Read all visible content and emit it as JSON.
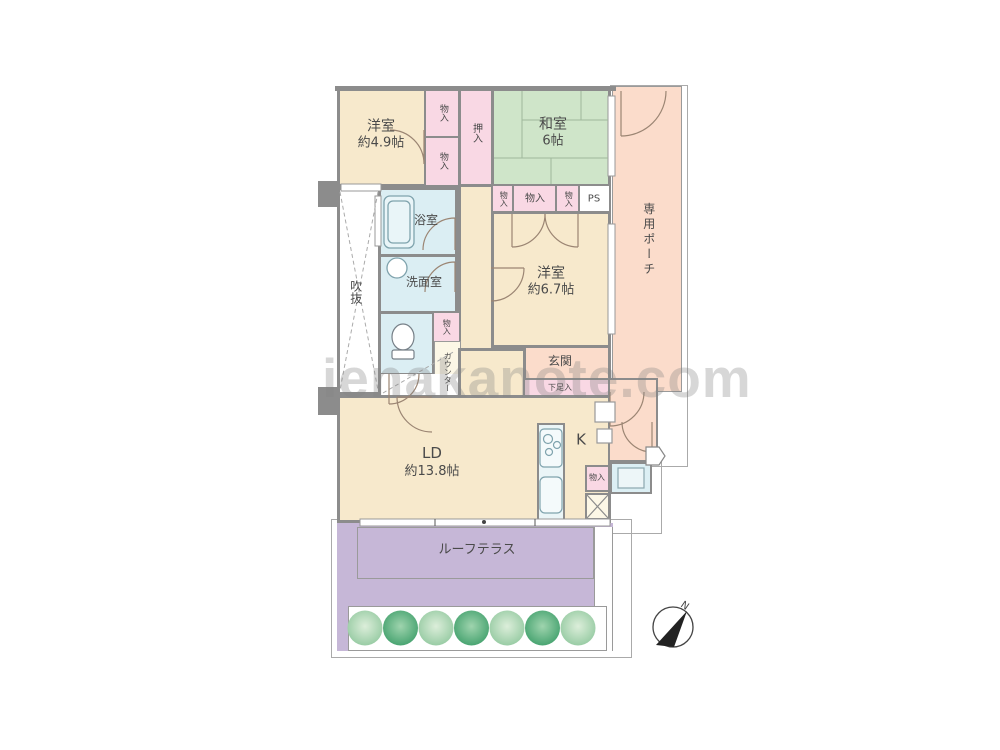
{
  "watermark": "ienakanote.com",
  "compass": {
    "north_label": "N"
  },
  "rooms": {
    "yoshitsu49": {
      "name": "洋室",
      "size": "約4.9帖"
    },
    "washitsu": {
      "name": "和室",
      "size": "6帖"
    },
    "yoshitsu67": {
      "name": "洋室",
      "size": "約6.7帖"
    },
    "ld": {
      "name": "LD",
      "size": "約13.8帖"
    },
    "kitchen": {
      "label": "K"
    },
    "bath": {
      "label": "浴室"
    },
    "senmen": {
      "label": "洗面室"
    },
    "void": {
      "label": "吹抜"
    },
    "genkan": {
      "label": "玄関"
    },
    "getabako": {
      "label": "下足入"
    },
    "counter": {
      "label": "カウンター"
    },
    "porch": {
      "label": "専用ポーチ"
    },
    "terrace": {
      "label": "ルーフテラス"
    },
    "oshiire": {
      "label": "押入"
    },
    "ps": {
      "label": "PS"
    },
    "storage": {
      "label": "物入"
    }
  },
  "colors": {
    "wall": "#8C8C8C",
    "room_beige": "#F7E9CC",
    "tatami_green": "#CFE5C9",
    "closet_pink": "#F9D8E4",
    "water_blue": "#DBEEF3",
    "porch_salmon": "#FBDCCB",
    "terrace_purple": "#C6B7D7",
    "tree_dark": "#41A06C",
    "tree_light": "#93C9A0"
  }
}
